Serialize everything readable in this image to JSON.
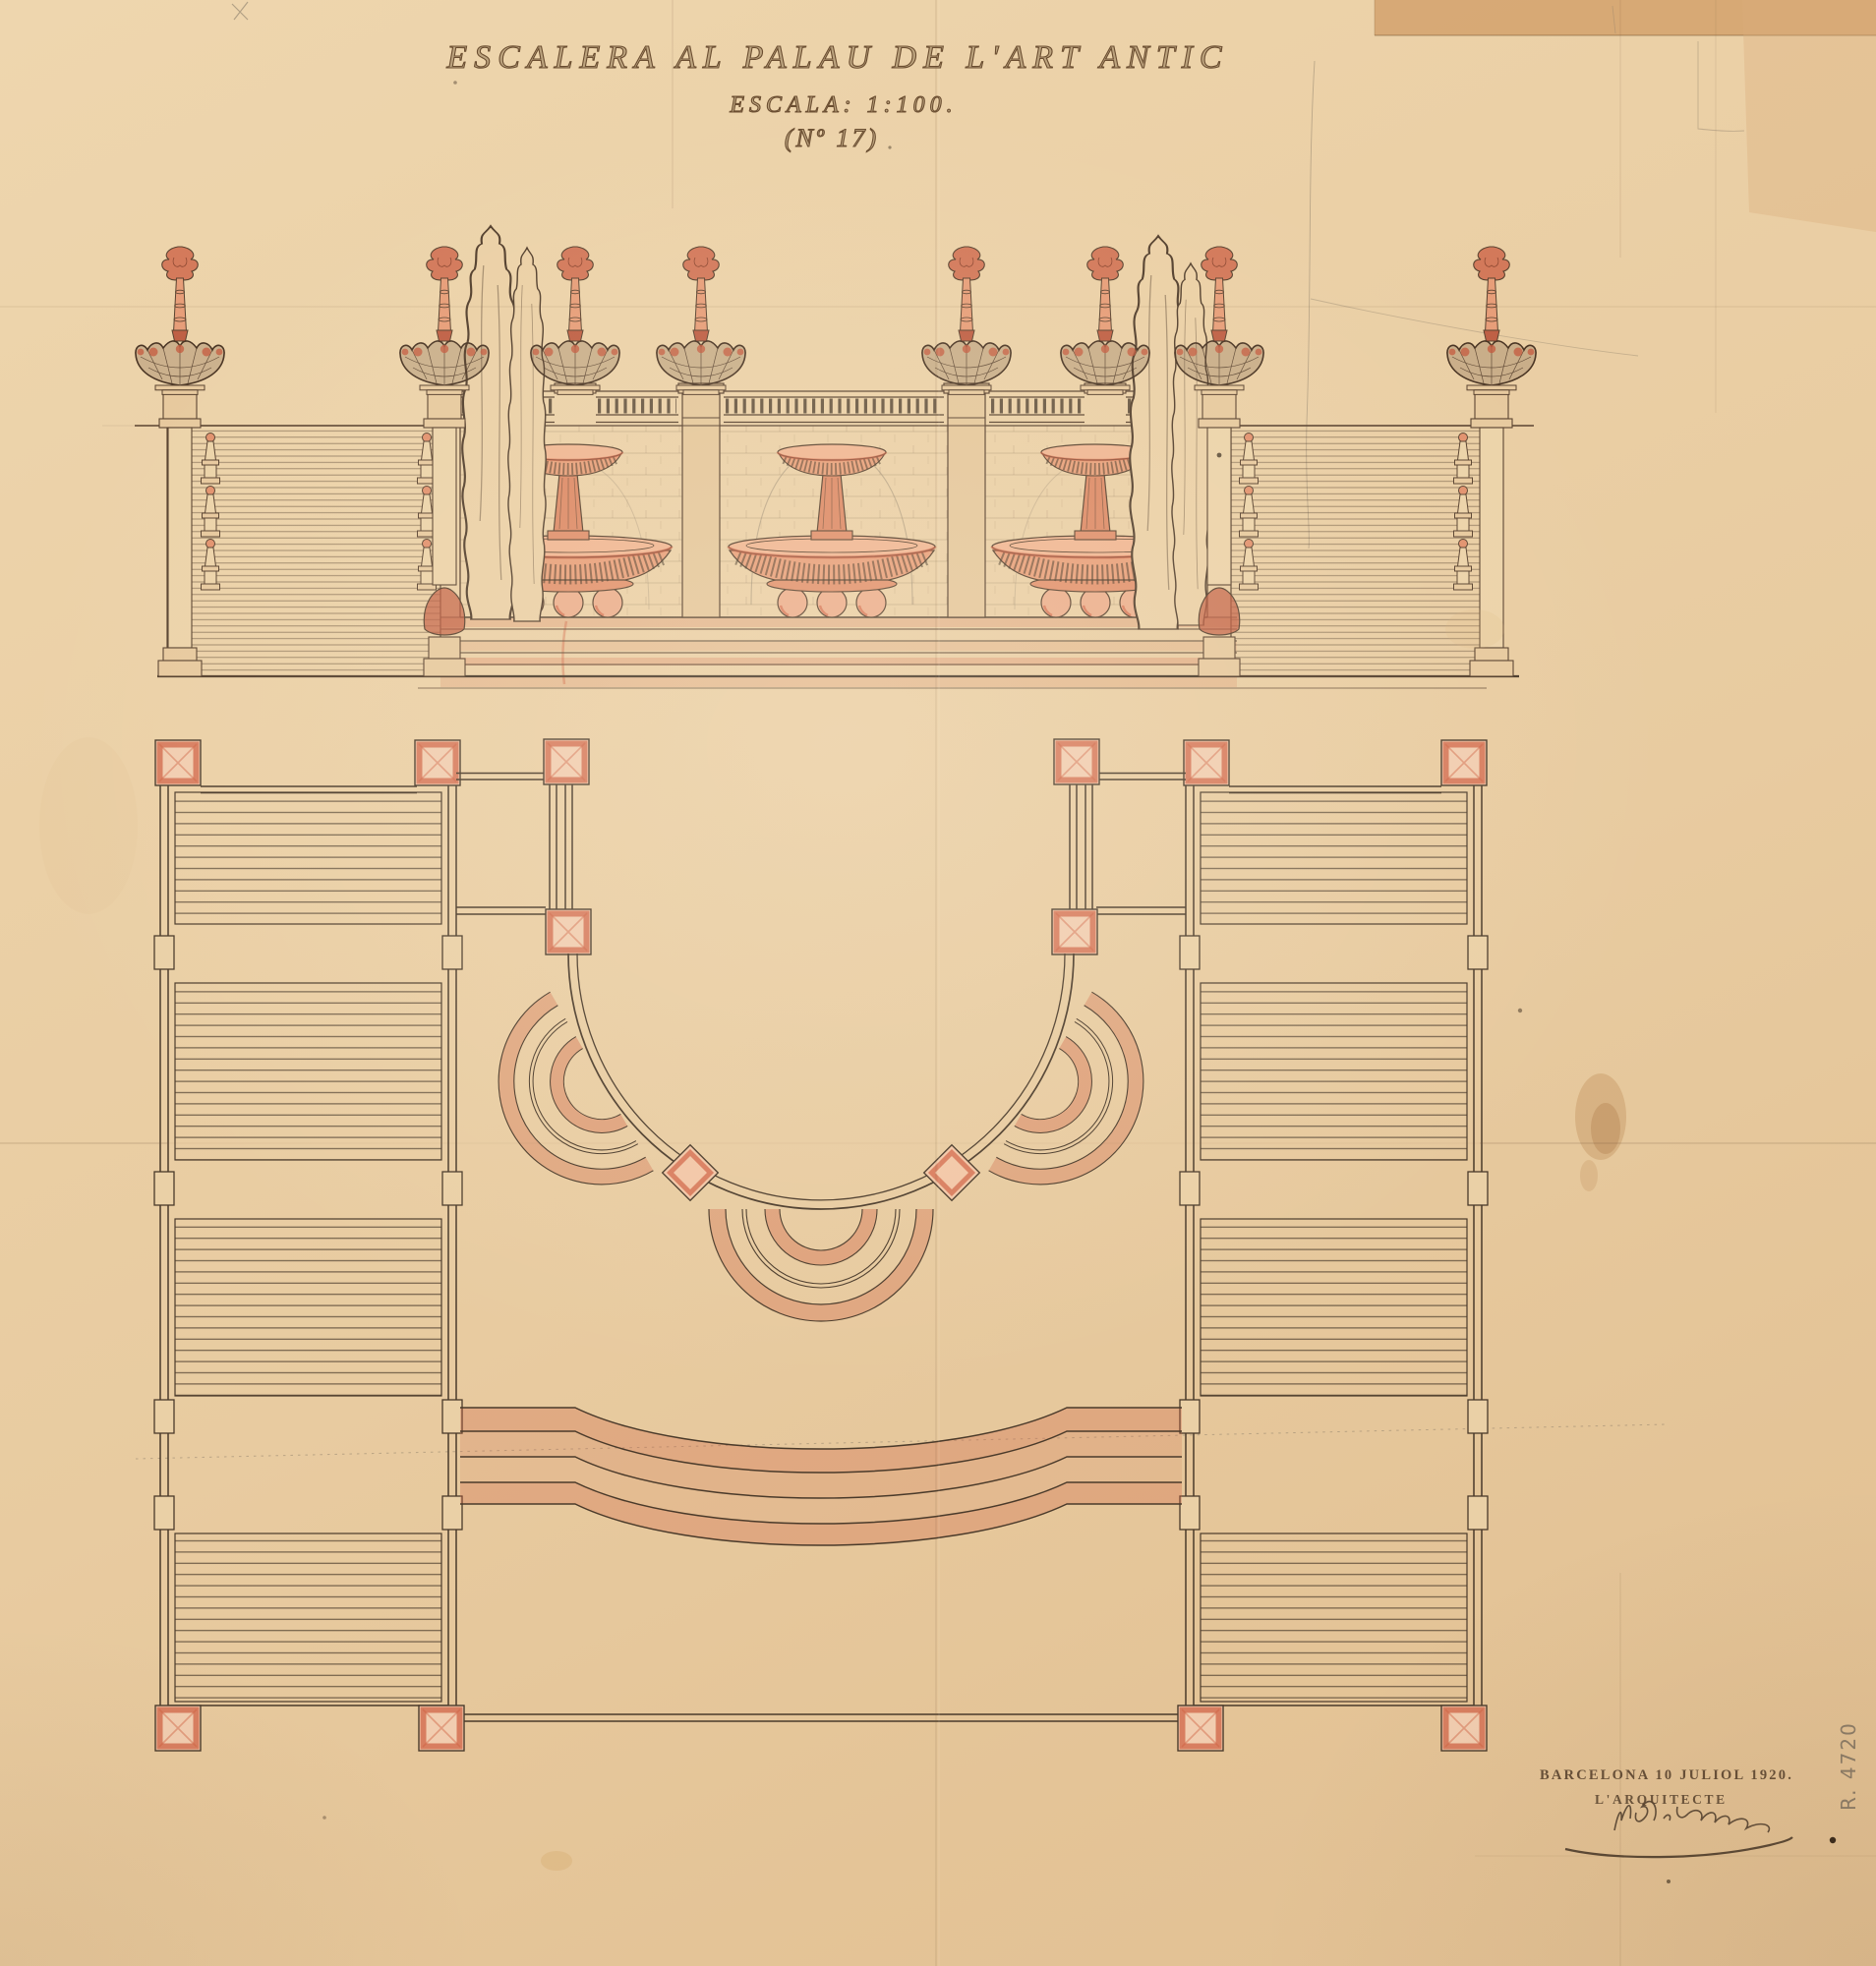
{
  "sheet": {
    "title": "ESCALERA AL PALAU DE L'ART ANTIC",
    "scale_label": "ESCALA: 1:100.",
    "sheet_number": "(Nº 17)",
    "place_date": "BARCELONA 10 JULIOL 1920.",
    "signed_by": "L'ARQUITECTE",
    "archive_ref": "R. 4720"
  },
  "colors": {
    "paper": "#e9cda2",
    "ink": "#4a3a2a",
    "sanguine": "#cf5f41",
    "pencil": "#8b7d6a",
    "patch_paper": "#d5a470"
  }
}
